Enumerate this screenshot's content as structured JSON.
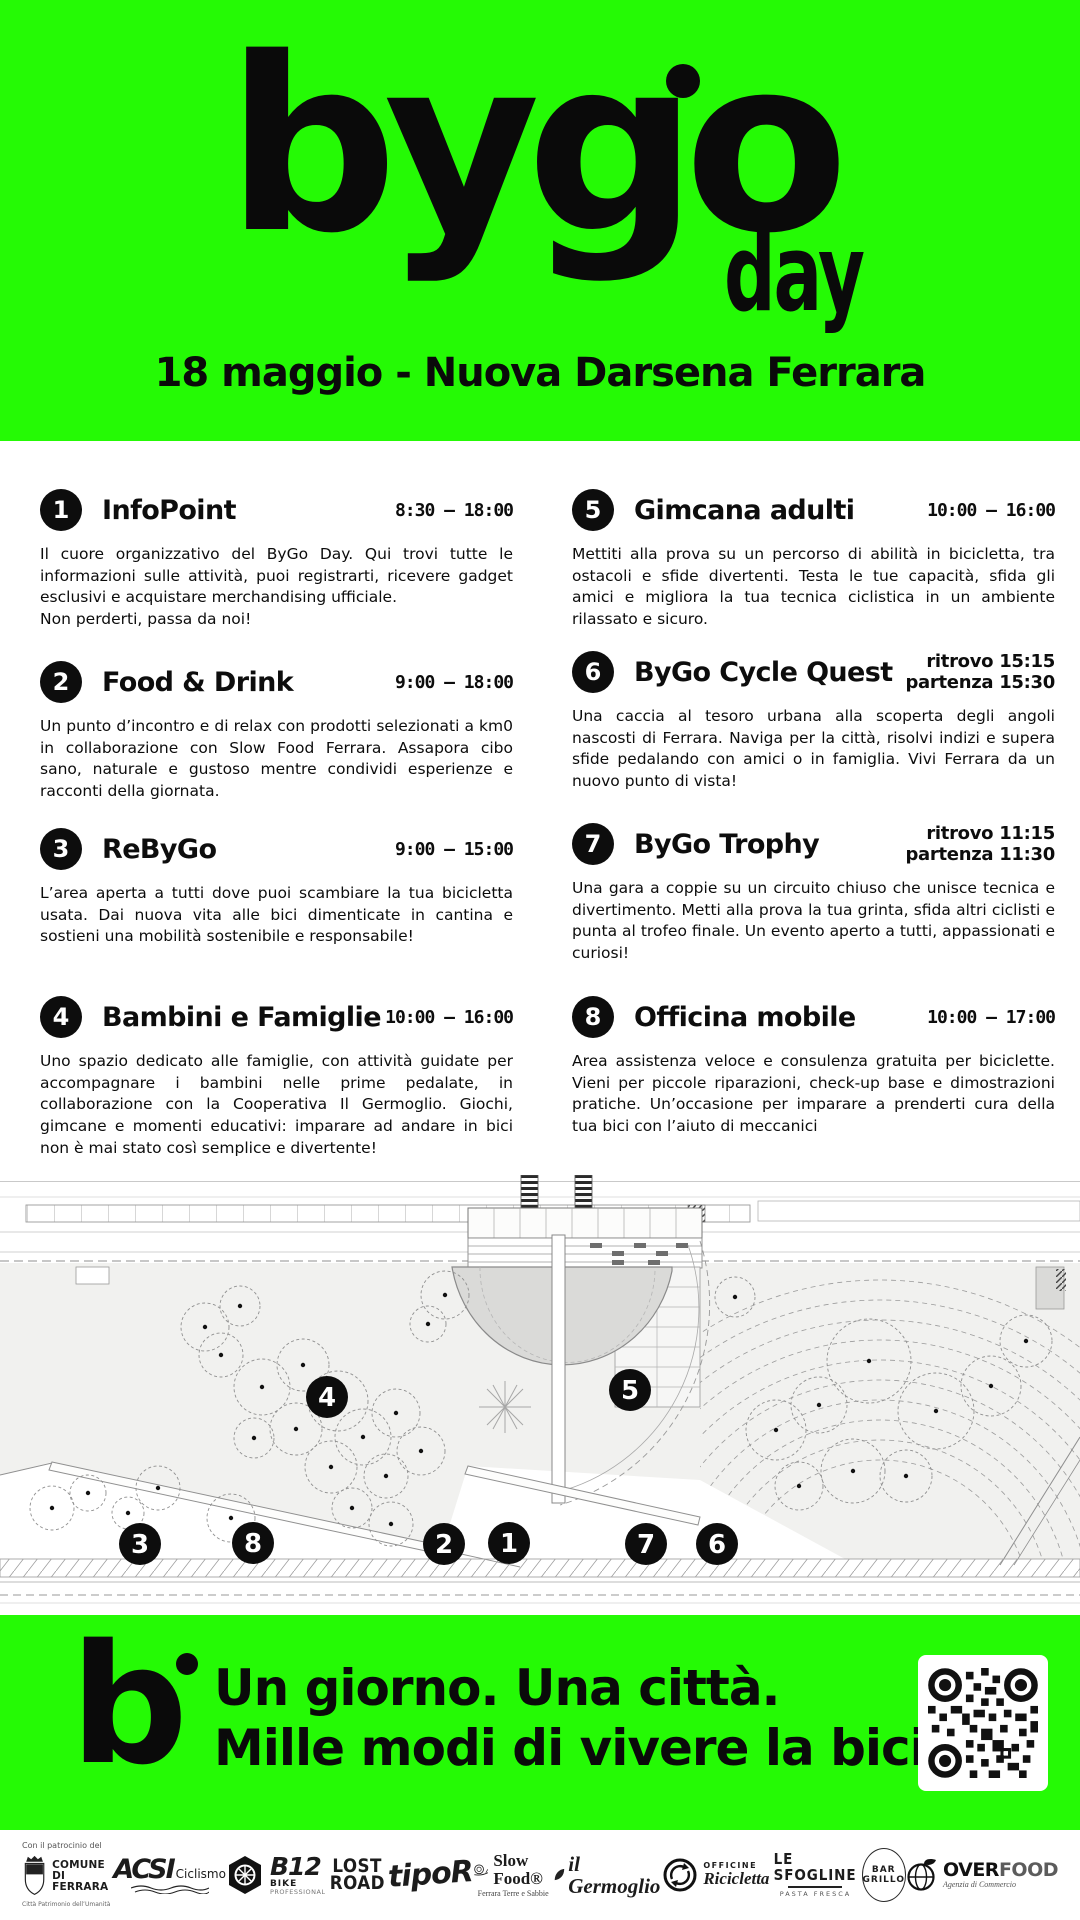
{
  "colors": {
    "accent_green": "#25fa05",
    "ink": "#0d0d0d"
  },
  "header": {
    "logo": "bygo",
    "logo_day": "day",
    "subtitle": "18 maggio - Nuova Darsena Ferrara"
  },
  "events": [
    {
      "num": "1",
      "title": "InfoPoint",
      "time": "8:30 – 18:00",
      "desc": "Il cuore organizzativo del ByGo Day. Qui trovi tutte le informazioni sulle attività, puoi registrarti, ricevere gadget esclusivi e acquistare merchandising ufficiale.",
      "desc2": "Non perderti, passa da noi!"
    },
    {
      "num": "2",
      "title": "Food & Drink",
      "time": "9:00 – 18:00",
      "desc": "Un punto d’incontro e di relax con prodotti selezionati a km0 in collaborazione con Slow Food Ferrara. Assapora cibo sano, naturale e gustoso mentre condividi esperienze e racconti della giornata."
    },
    {
      "num": "3",
      "title": "ReByGo",
      "time": "9:00 – 15:00",
      "desc": "L’area aperta a tutti dove puoi scambiare la tua bicicletta usata. Dai nuova vita alle bici dimenticate in cantina e sostieni una mobilità sostenibile e responsabile!"
    },
    {
      "num": "4",
      "title": "Bambini e Famiglie",
      "time": "10:00 – 16:00",
      "desc": "Uno spazio dedicato alle famiglie, con attività guidate per accompagnare i bambini nelle prime pedalate, in collaborazione con la Cooperativa Il Germoglio. Giochi, gimcane e momenti educativi: imparare ad andare in bici non è mai stato così semplice e divertente!"
    },
    {
      "num": "5",
      "title": "Gimcana adulti",
      "time": "10:00 – 16:00",
      "desc": "Mettiti alla prova su un percorso di abilità in bicicletta, tra ostacoli e sfide divertenti. Testa le tue capacità, sfida gli amici e migliora la tua tecnica ciclistica in un ambiente rilassato e sicuro."
    },
    {
      "num": "6",
      "title": "ByGo Cycle Quest",
      "time_line1": "ritrovo 15:15",
      "time_line2": "partenza 15:30",
      "desc": "Una caccia al tesoro urbana alla scoperta degli angoli nascosti di Ferrara. Naviga per la città, risolvi indizi e supera sfide pedalando con amici o in famiglia. Vivi Ferrara da un nuovo punto di vista!"
    },
    {
      "num": "7",
      "title": "ByGo Trophy",
      "time_line1": "ritrovo 11:15",
      "time_line2": "partenza 11:30",
      "desc": "Una gara a coppie su un circuito chiuso che unisce tecnica e divertimento. Metti alla prova la tua grinta, sfida altri ciclisti e punta al trofeo finale. Un evento aperto a tutti, appassionati e curiosi!"
    },
    {
      "num": "8",
      "title": "Officina mobile",
      "time": "10:00 – 17:00",
      "desc": "Area assistenza veloce e consulenza gratuita per biciclette. Vieni per piccole riparazioni, check-up base e dimostrazioni pratiche. Un’occasione per imparare a prenderti cura della tua bici con l’aiuto di meccanici"
    }
  ],
  "map": {
    "markers": [
      {
        "label": "1"
      },
      {
        "label": "2"
      },
      {
        "label": "3"
      },
      {
        "label": "4"
      },
      {
        "label": "5"
      },
      {
        "label": "6"
      },
      {
        "label": "7"
      },
      {
        "label": "8"
      }
    ]
  },
  "footer": {
    "logo_mark": "b",
    "tagline1": "Un giorno. Una città.",
    "tagline2": "Mille modi di vivere la bici."
  },
  "sponsors": {
    "patronage_label": "Con il patrocinio del",
    "items": [
      {
        "name": "Comune di Ferrara",
        "line1": "COMUNE",
        "line2": "DI FERRARA",
        "sub": "Città Patrimonio dell’Umanità"
      },
      {
        "name": "ACSI Ciclismo",
        "text": "ACSI",
        "sub": "Ciclismo"
      },
      {
        "name": "B12 Bike Professional",
        "text": "B12",
        "sub": "BIKE",
        "sub2": "PROFESSIONAL"
      },
      {
        "name": "Lost Road",
        "line1": "LOST",
        "line2": "ROAD"
      },
      {
        "name": "tipoR",
        "text": "tipoR"
      },
      {
        "name": "Slow Food Ferrara",
        "text": "Slow Food®",
        "sub": "Ferrara Terre e Sabbie"
      },
      {
        "name": "il Germoglio",
        "text": "il Germoglio"
      },
      {
        "name": "Officine Ricicletta",
        "sub": "OFFICINE",
        "text": "Ricicletta"
      },
      {
        "name": "Le Sfogline",
        "text": "LE SFOGLINE",
        "sub": "PASTA FRESCA"
      },
      {
        "name": "Bar Grillo",
        "line1": "BAR",
        "line2": "GRILLO"
      },
      {
        "name": "Overfood",
        "text": "OVER",
        "text2": "FOOD",
        "sub": "Agenzia di Commercio"
      }
    ]
  }
}
